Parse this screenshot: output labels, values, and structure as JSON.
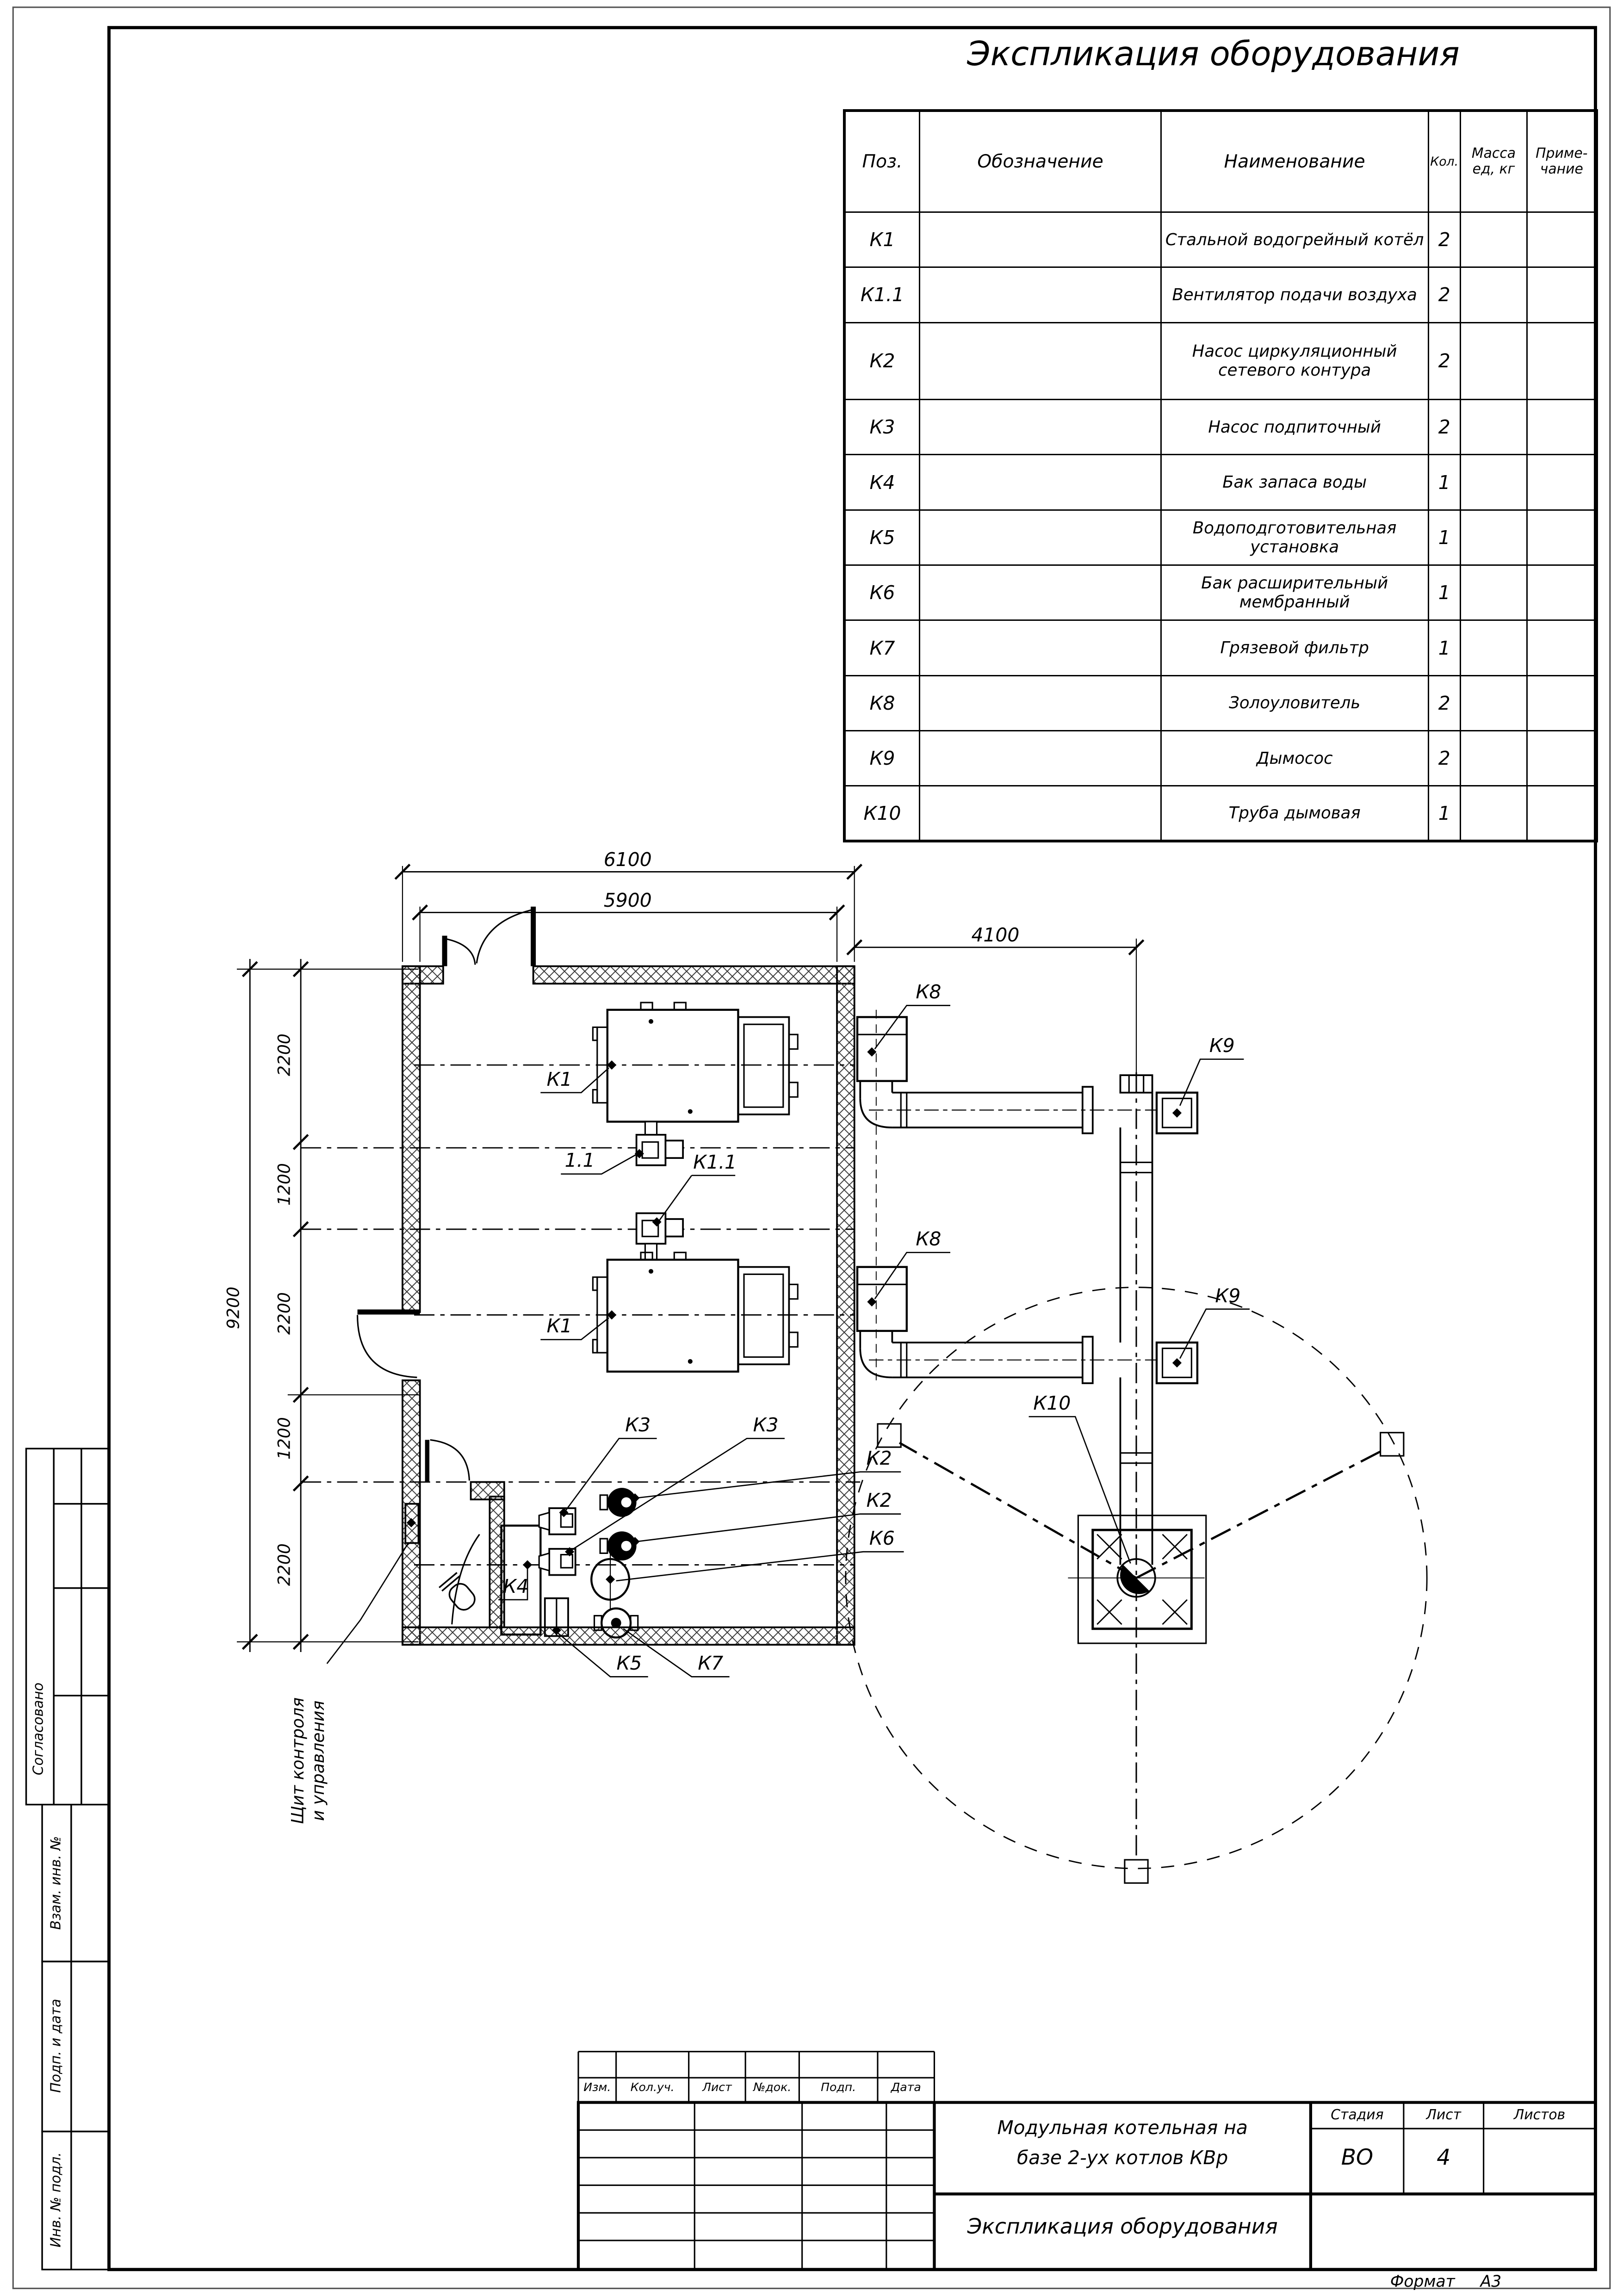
{
  "title": "Экспликация оборудования",
  "table": {
    "headers": {
      "pos": "Поз.",
      "designation": "Обозначение",
      "name": "Наименование",
      "qty": "Кол.",
      "mass": "Масса\nед, кг",
      "note": "Приме-\nчание"
    },
    "rows": [
      {
        "pos": "К1",
        "name": "Стальной водогрейный котёл",
        "qty": "2"
      },
      {
        "pos": "К1.1",
        "name": "Вентилятор подачи воздуха",
        "qty": "2"
      },
      {
        "pos": "К2",
        "name": "Насос циркуляционный\nсетевого контура",
        "qty": "2"
      },
      {
        "pos": "К3",
        "name": "Насос подпиточный",
        "qty": "2"
      },
      {
        "pos": "К4",
        "name": "Бак запаса воды",
        "qty": "1"
      },
      {
        "pos": "К5",
        "name": "Водоподготовительная установка",
        "qty": "1"
      },
      {
        "pos": "К6",
        "name": "Бак расширительный мембранный",
        "qty": "1"
      },
      {
        "pos": "К7",
        "name": "Грязевой фильтр",
        "qty": "1"
      },
      {
        "pos": "К8",
        "name": "Золоуловитель",
        "qty": "2"
      },
      {
        "pos": "К9",
        "name": "Дымосос",
        "qty": "2"
      },
      {
        "pos": "К10",
        "name": "Труба дымовая",
        "qty": "1"
      }
    ]
  },
  "plan": {
    "dims": {
      "overall_width": "6100",
      "inner_width": "5900",
      "chimney_offset": "4100",
      "overall_height": "9200",
      "segments": [
        "2200",
        "1200",
        "2200",
        "1200",
        "2200"
      ]
    },
    "labels": {
      "boiler_top": "К1",
      "boiler_bottom": "К1",
      "fan_top": "1.1",
      "fan_bottom": "К1.1",
      "pump_feed_1": "К3",
      "pump_feed_2": "К3",
      "pump_circ_1": "К2",
      "pump_circ_2": "К2",
      "exp_tank": "К6",
      "water_tank": "К4",
      "water_treatment": "К5",
      "mud_filter": "К7",
      "ash_top": "К8",
      "ash_bottom": "К8",
      "exhauster_top": "К9",
      "exhauster_bottom": "К9",
      "chimney": "К10",
      "control_panel": "Щит контроля\nи управления"
    }
  },
  "stamp": {
    "rev_headers": [
      "Изм.",
      "Кол.уч.",
      "Лист",
      "№док.",
      "Подп.",
      "Дата"
    ],
    "project": "Модульная котельная на\nбазе 2-ух котлов КВр",
    "doc_title": "Экспликация оборудования",
    "stage_header": "Стадия",
    "sheet_header": "Лист",
    "sheets_header": "Листов",
    "stage": "ВО",
    "sheet": "4",
    "sheets": "",
    "format_note": "Формат     А3"
  },
  "sidebar": {
    "agreed": "Согласовано",
    "replace_inv": "Взам. инв. №",
    "sign_date": "Подп. и дата",
    "inv_orig": "Инв. № подл."
  }
}
